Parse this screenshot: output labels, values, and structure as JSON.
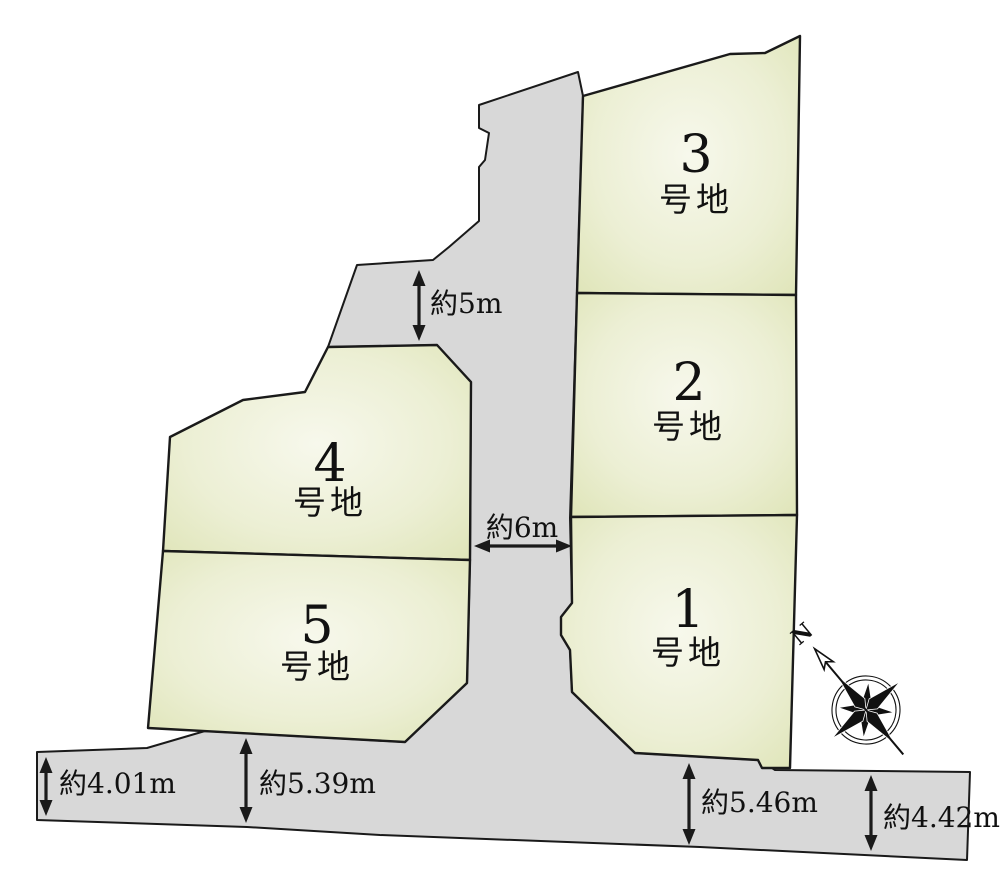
{
  "page": {
    "background": "#ffffff",
    "line_color": "#1a1a1a",
    "road_fill": "#d8d8d8",
    "lot_fill_outer": "#dde3b4",
    "lot_fill_inner": "#f7f8ec",
    "text_color": "#111111"
  },
  "road": {
    "name": "road",
    "points": "578,72 479,105 479,128 489,133 485,160 479,167 479,221 449,247 433,260 357,265 328,347 437,345 471,382 470,560 467,683 405,742 205,731 147,748 37,752 37,820 247,827 380,835 700,847 967,860 970,772 775,770 772,768 758,760 635,753 572,692 570,650 561,635 561,617 572,603 570,518 577,293 583,96"
  },
  "lots": [
    {
      "id": "lot-3",
      "number": "3",
      "suffix": "号地",
      "points": "583,96 730,54 765,53 800,36 796,295 577,293",
      "label_x": 696,
      "num_y": 172,
      "suffix_y": 211
    },
    {
      "id": "lot-2",
      "number": "2",
      "suffix": "号地",
      "points": "577,293 796,295 797,515 571,517",
      "label_x": 689,
      "num_y": 400,
      "suffix_y": 438
    },
    {
      "id": "lot-1",
      "number": "1",
      "suffix": "号地",
      "points": "571,517 797,515 790,768 762,768 758,760 635,753 572,692 570,650 561,635 561,617 572,603",
      "label_x": 688,
      "num_y": 627,
      "suffix_y": 664
    },
    {
      "id": "lot-4",
      "number": "4",
      "suffix": "号地",
      "points": "328,347 437,345 471,382 470,560 163,551 170,437 243,400 305,392",
      "label_x": 330,
      "num_y": 481,
      "suffix_y": 514
    },
    {
      "id": "lot-5",
      "number": "5",
      "suffix": "号地",
      "points": "163,551 470,560 467,683 405,742 148,728",
      "label_x": 317,
      "num_y": 643,
      "suffix_y": 678
    }
  ],
  "dimensions": [
    {
      "id": "dim-5m",
      "label": "約5m",
      "dir": "v",
      "x": 419,
      "y1": 270,
      "y2": 341,
      "tx": 430,
      "ty": 313,
      "anchor": "start"
    },
    {
      "id": "dim-6m",
      "label": "約6m",
      "dir": "h",
      "y": 546,
      "x1": 474,
      "x2": 572,
      "tx": 522,
      "ty": 537,
      "anchor": "middle"
    },
    {
      "id": "dim-4-01m",
      "label": "約4.01m",
      "dir": "v",
      "x": 46,
      "y1": 757,
      "y2": 816,
      "tx": 59,
      "ty": 793,
      "anchor": "start"
    },
    {
      "id": "dim-5-39m",
      "label": "約5.39m",
      "dir": "v",
      "x": 246,
      "y1": 738,
      "y2": 823,
      "tx": 259,
      "ty": 793,
      "anchor": "start"
    },
    {
      "id": "dim-5-46m",
      "label": "約5.46m",
      "dir": "v",
      "x": 689,
      "y1": 763,
      "y2": 845,
      "tx": 701,
      "ty": 812,
      "anchor": "start"
    },
    {
      "id": "dim-4-42m",
      "label": "約4.42m",
      "dir": "v",
      "x": 871,
      "y1": 775,
      "y2": 851,
      "tx": 883,
      "ty": 827,
      "anchor": "start"
    }
  ],
  "compass": {
    "label": "N",
    "cx": 866,
    "cy": 710,
    "rotation": -40,
    "ring_r1": 30,
    "ring_r2": 34,
    "long_point": 44,
    "short_point": 28,
    "needle_tail": 58,
    "needle_tip": 80
  }
}
